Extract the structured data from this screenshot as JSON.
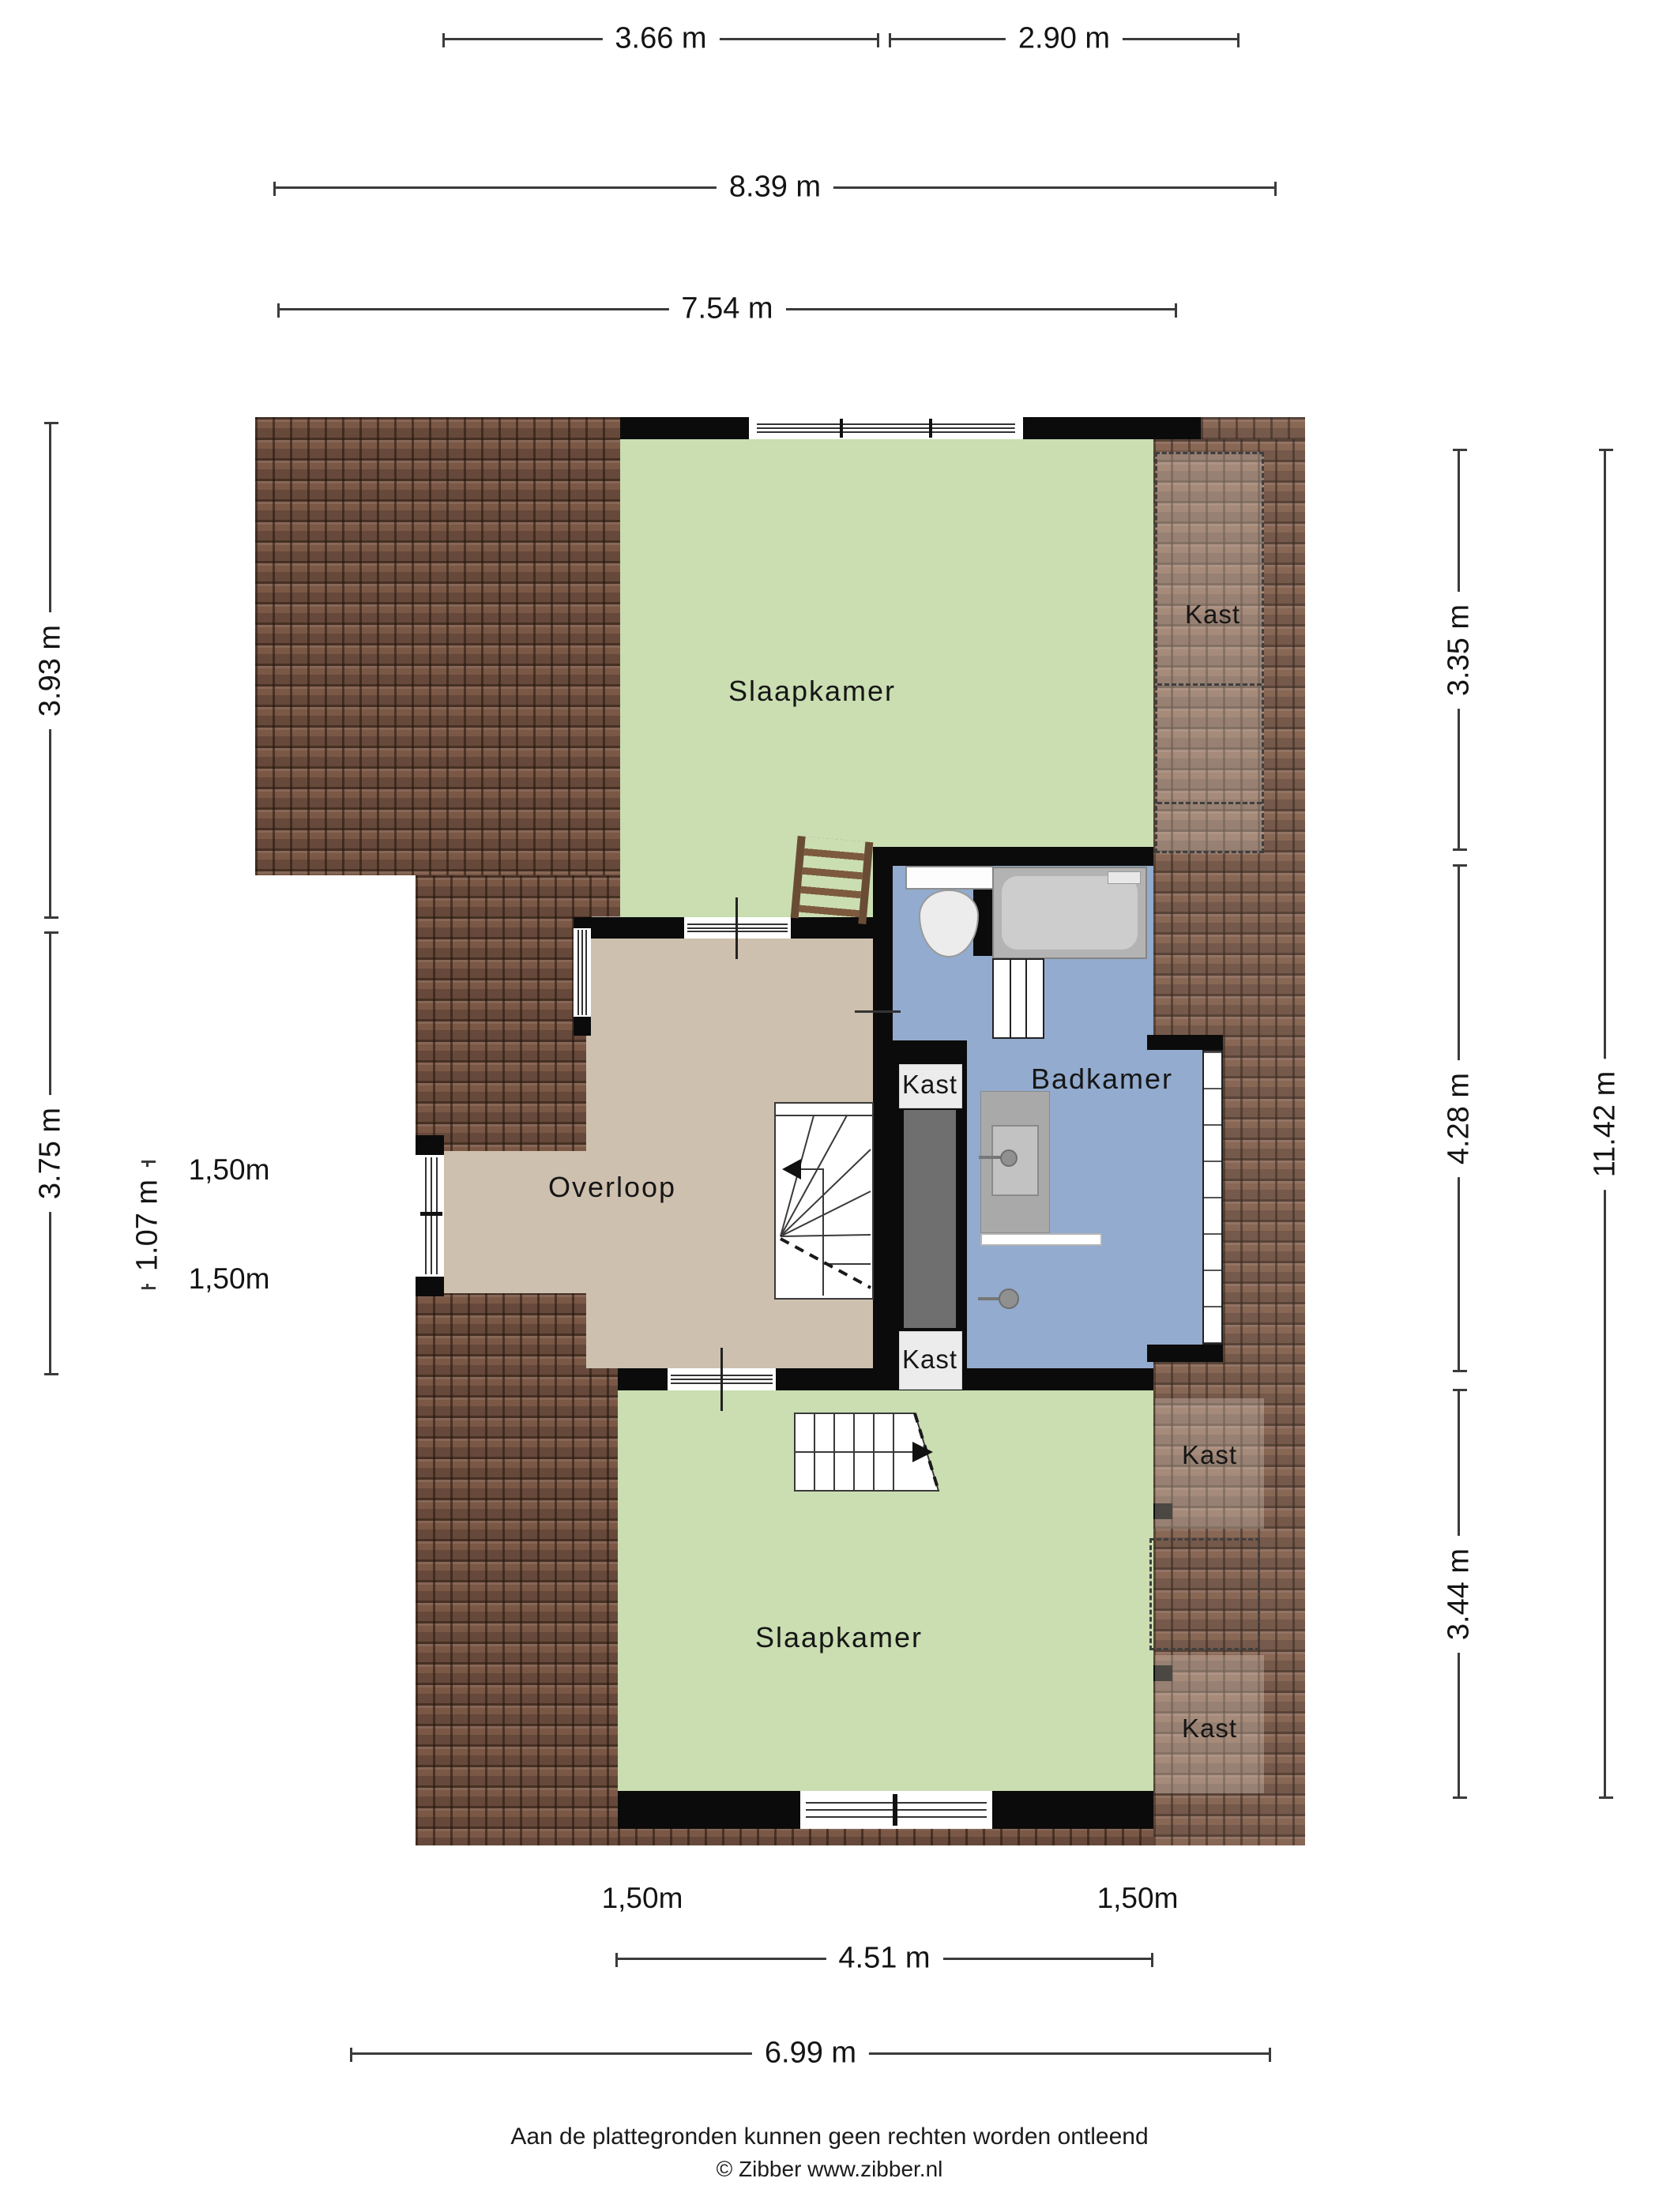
{
  "dims": {
    "top": [
      {
        "label": "3.66 m"
      },
      {
        "label": "2.90 m"
      },
      {
        "label": "8.39 m"
      },
      {
        "label": "7.54 m"
      }
    ],
    "left": [
      {
        "label": "3.93 m"
      },
      {
        "label": "3.75 m"
      },
      {
        "label": "1.07 m"
      },
      {
        "label": "1,50m"
      },
      {
        "label": "1,50m"
      }
    ],
    "right": [
      {
        "label": "3.35 m"
      },
      {
        "label": "4.28 m"
      },
      {
        "label": "3.44 m"
      },
      {
        "label": "11.42 m"
      }
    ],
    "bottom": [
      {
        "label": "1,50m"
      },
      {
        "label": "1,50m"
      },
      {
        "label": "4.51 m"
      },
      {
        "label": "6.99 m"
      }
    ]
  },
  "rooms": {
    "bedroom_top": "Slaapkamer",
    "bedroom_bottom": "Slaapkamer",
    "bathroom": "Badkamer",
    "landing": "Overloop"
  },
  "closet_labels": [
    "Kast",
    "Kast",
    "Kast",
    "Kast",
    "Kast"
  ],
  "footer": {
    "disclaimer": "Aan de plattegronden kunnen geen rechten worden ontleend",
    "copyright": "© Zibber www.zibber.nl"
  },
  "colors": {
    "roof": "#7b5846",
    "roof_joint": "#2e1f14",
    "bedroom_fill": "#cadeb1",
    "bathroom_fill": "#92abce",
    "landing_fill": "#cec0ae",
    "wall": "#0b0b0b",
    "closet_floor": "#ececec",
    "shaft": "#6f6f6f",
    "dimension_line": "#3b3b3b"
  }
}
